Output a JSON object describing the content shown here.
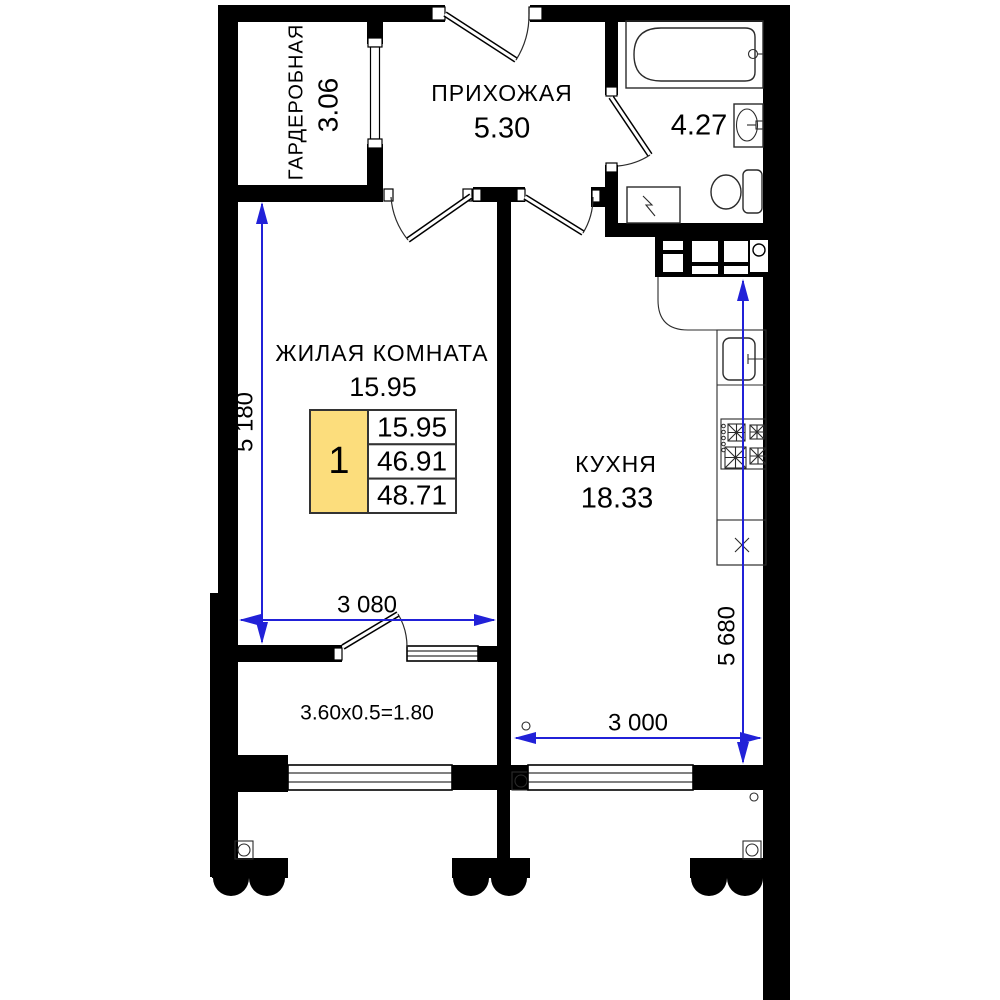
{
  "rooms": {
    "wardrobe": {
      "name": "ГАРДЕРОБНАЯ",
      "area": "3.06"
    },
    "hallway": {
      "name": "ПРИХОЖАЯ",
      "area": "5.30"
    },
    "bathroom": {
      "area": "4.27"
    },
    "living_room": {
      "name": "ЖИЛАЯ КОМНАТА",
      "area": "15.95"
    },
    "kitchen": {
      "name": "КУХНЯ",
      "area": "18.33"
    },
    "balcony": {
      "formula": "3.60x0.5=1.80"
    }
  },
  "summary_box": {
    "rooms_count": "1",
    "living_area": "15.95",
    "apartment_area": "46.91",
    "total_area": "48.71"
  },
  "dimensions": {
    "living_height": "5 180",
    "living_width": "3 080",
    "kitchen_height": "5 680",
    "kitchen_width": "3 000"
  },
  "colors": {
    "wall": "#000000",
    "dimension_blue": "#2121d8",
    "highlight_yellow": "#fcdd7c"
  }
}
